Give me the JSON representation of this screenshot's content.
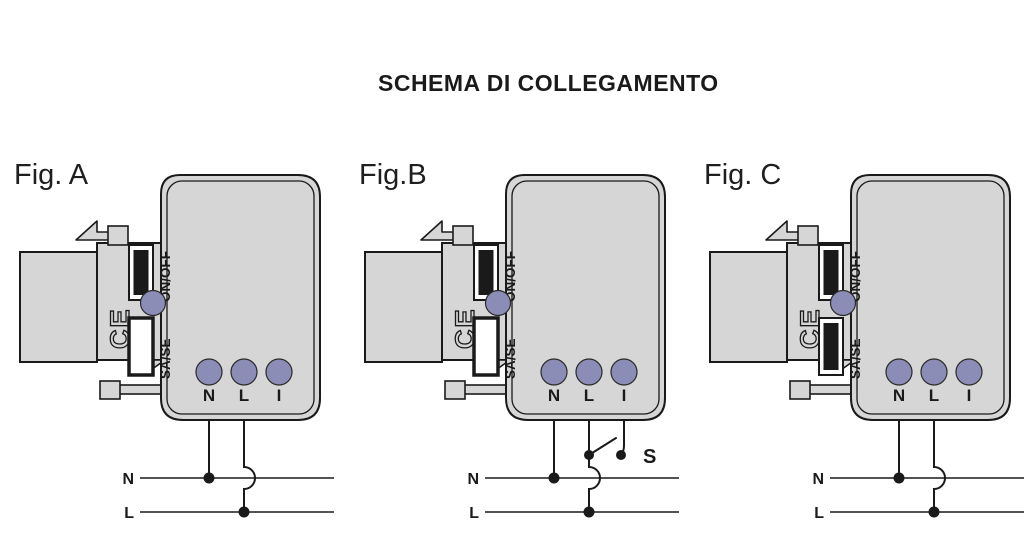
{
  "title": "SCHEMA DI COLLEGAMENTO",
  "colors": {
    "background": "#ffffff",
    "body_fill": "#d6d6d6",
    "outline": "#1a1a1a",
    "terminal_fill": "#8b8db6"
  },
  "figures": [
    {
      "id": "A",
      "label": "Fig. A",
      "device": {
        "on_off_label": "ON/OFF",
        "sa_se_label": "SA/SE",
        "ce_mark": "CE",
        "sa_se_state": "hollow",
        "terminals": [
          "N",
          "L",
          "I"
        ]
      },
      "wiring": {
        "supply_lines": [
          "N",
          "L"
        ],
        "connected_terminals": [
          "N",
          "L"
        ],
        "switch_label": null
      }
    },
    {
      "id": "B",
      "label": "Fig.B",
      "device": {
        "on_off_label": "ON/OFF",
        "sa_se_label": "SA/SE",
        "ce_mark": "CE",
        "sa_se_state": "hollow",
        "terminals": [
          "N",
          "L",
          "I"
        ]
      },
      "wiring": {
        "supply_lines": [
          "N",
          "L"
        ],
        "connected_terminals": [
          "N",
          "L",
          "I"
        ],
        "switch_label": "S"
      }
    },
    {
      "id": "C",
      "label": "Fig. C",
      "device": {
        "on_off_label": "ON/OFF",
        "sa_se_label": "SA/SE",
        "ce_mark": "CE",
        "sa_se_state": "filled",
        "terminals": [
          "N",
          "L",
          "I"
        ]
      },
      "wiring": {
        "supply_lines": [
          "N",
          "L"
        ],
        "connected_terminals": [
          "N",
          "L"
        ],
        "switch_label": null
      }
    }
  ]
}
